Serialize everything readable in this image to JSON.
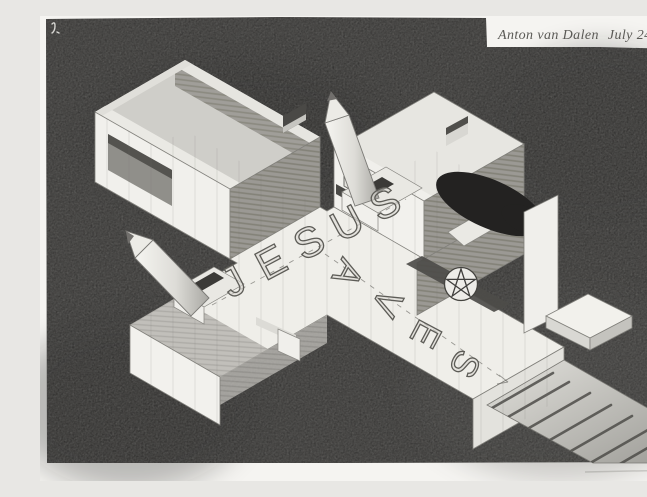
{
  "signature": {
    "artist": "Anton van Dalen",
    "date": "July 24+25, '04"
  },
  "words": {
    "across": "JESUS",
    "down": "SAVES"
  },
  "letters": {
    "jesus": [
      "J",
      "E",
      "S",
      "U",
      "S"
    ],
    "saves": [
      "S",
      "A",
      "V",
      "E",
      "S"
    ]
  },
  "icons": {
    "pentagram": "five-pointed-star-in-circle",
    "pencil_spikes": "pencil-shaped-spike",
    "corner_mark": "small-handwritten-squiggle"
  },
  "colors": {
    "ink_field": "#242322",
    "paper": "#f5f4f1",
    "structure_white": "#f1f0ec",
    "hatch_gray": "#9b9994",
    "band_dark": "#4d4c49",
    "pencil_line": "#6f6e6a"
  }
}
